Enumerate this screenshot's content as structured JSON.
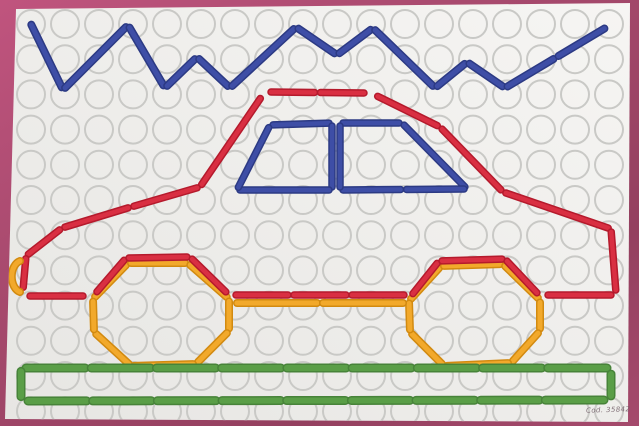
{
  "board": {
    "width": 639,
    "height": 426,
    "caption": "Cod. 35842",
    "caption_pos": {
      "x": 586,
      "y": 406
    },
    "frame_color_top": "#c0547e",
    "frame_color_bottom": "#94405f",
    "surface_color_light": "#f6f5f3",
    "surface_color_dark": "#e7e6e3",
    "corners": "16,9 630,3 628,422 5,419",
    "hole_grid": {
      "cols": 18,
      "rows": 12,
      "origin_x": 31,
      "origin_y": 24,
      "spacing_x": 34,
      "spacing_y": 35.2,
      "radius": 14,
      "stroke": "#c9c9c6",
      "stroke_width": 2
    }
  },
  "palette": {
    "blue": {
      "main": "#3e4ea6",
      "dark": "#2c3a84"
    },
    "red": {
      "main": "#d92f42",
      "dark": "#b51a2c"
    },
    "orange": {
      "main": "#f2a92b",
      "dark": "#d28a10"
    },
    "green": {
      "main": "#5a9e47",
      "dark": "#478339"
    }
  },
  "figure": {
    "description": "peg-stick picture of a car with mountains and road",
    "shapes": [
      {
        "name": "mountain-range",
        "color": "blue",
        "width": 8,
        "type": "polyline",
        "maxlen": 70,
        "points": [
          [
            30,
            22
          ],
          [
            63,
            90
          ],
          [
            128,
            25
          ],
          [
            165,
            88
          ],
          [
            197,
            57
          ],
          [
            230,
            88
          ],
          [
            296,
            27
          ],
          [
            337,
            55
          ],
          [
            373,
            28
          ],
          [
            435,
            88
          ],
          [
            467,
            62
          ],
          [
            505,
            88
          ],
          [
            607,
            27
          ]
        ]
      },
      {
        "name": "car-roof",
        "color": "red",
        "width": 7.5,
        "type": "polyline",
        "maxlen": 60,
        "points": [
          [
            268,
            92
          ],
          [
            367,
            93
          ]
        ]
      },
      {
        "name": "car-front-profile",
        "color": "red",
        "width": 7.5,
        "type": "polyline",
        "maxlen": 75,
        "points": [
          [
            262,
            96
          ],
          [
            200,
            187
          ],
          [
            131,
            207
          ],
          [
            62,
            228
          ],
          [
            26,
            256
          ],
          [
            23,
            290
          ]
        ]
      },
      {
        "name": "car-rear-profile",
        "color": "red",
        "width": 7.5,
        "type": "polyline",
        "maxlen": 95,
        "points": [
          [
            375,
            95
          ],
          [
            440,
            127
          ],
          [
            503,
            192
          ],
          [
            611,
            229
          ],
          [
            616,
            293
          ]
        ]
      },
      {
        "name": "car-floor-front",
        "color": "red",
        "width": 7.5,
        "type": "polyline",
        "maxlen": 65,
        "points": [
          [
            27,
            296
          ],
          [
            86,
            296
          ]
        ]
      },
      {
        "name": "car-floor-mid",
        "color": "red",
        "width": 7.5,
        "type": "polyline",
        "maxlen": 65,
        "points": [
          [
            233,
            295
          ],
          [
            407,
            295
          ]
        ]
      },
      {
        "name": "car-floor-rear",
        "color": "red",
        "width": 7.5,
        "type": "polyline",
        "maxlen": 65,
        "points": [
          [
            545,
            295
          ],
          [
            614,
            295
          ]
        ]
      },
      {
        "name": "left-window",
        "color": "blue",
        "width": 7.5,
        "type": "polygon",
        "maxlen": 75,
        "points": [
          [
            270,
            125
          ],
          [
            332,
            123
          ],
          [
            332,
            190
          ],
          [
            237,
            190
          ]
        ]
      },
      {
        "name": "right-window",
        "color": "blue",
        "width": 7.5,
        "type": "polygon",
        "maxlen": 75,
        "points": [
          [
            340,
            123
          ],
          [
            402,
            123
          ],
          [
            467,
            189
          ],
          [
            340,
            190
          ]
        ]
      },
      {
        "name": "front-wheel",
        "color": "orange",
        "width": 8,
        "type": "polygon",
        "maxlen": 85,
        "points": [
          [
            93,
            299
          ],
          [
            128,
            263
          ],
          [
            188,
            263
          ],
          [
            229,
            299
          ],
          [
            229,
            331
          ],
          [
            196,
            364
          ],
          [
            131,
            366
          ],
          [
            94,
            332
          ]
        ]
      },
      {
        "name": "rear-wheel",
        "color": "orange",
        "width": 8,
        "type": "polygon",
        "maxlen": 85,
        "points": [
          [
            409,
            301
          ],
          [
            441,
            266
          ],
          [
            503,
            264
          ],
          [
            540,
            300
          ],
          [
            540,
            331
          ],
          [
            511,
            363
          ],
          [
            444,
            366
          ],
          [
            410,
            332
          ]
        ]
      },
      {
        "name": "front-wheel-arch",
        "color": "red",
        "width": 7.5,
        "type": "polyline",
        "maxlen": 75,
        "points": [
          [
            95,
            294
          ],
          [
            126,
            258
          ],
          [
            190,
            257
          ],
          [
            228,
            294
          ]
        ]
      },
      {
        "name": "rear-wheel-arch",
        "color": "red",
        "width": 7.5,
        "type": "polyline",
        "maxlen": 75,
        "points": [
          [
            411,
            296
          ],
          [
            439,
            261
          ],
          [
            505,
            259
          ],
          [
            539,
            295
          ]
        ]
      },
      {
        "name": "axle-bar",
        "color": "orange",
        "width": 8,
        "type": "polyline",
        "maxlen": 95,
        "points": [
          [
            234,
            303
          ],
          [
            406,
            303
          ]
        ]
      },
      {
        "name": "front-bumper",
        "color": "orange",
        "width": 8,
        "type": "arc",
        "path": "M 20 261 A 11 16 0 0 0 20 292"
      },
      {
        "name": "ground-top",
        "color": "green",
        "width": 9,
        "type": "polyline",
        "maxlen": 62,
        "points": [
          [
            23,
            368
          ],
          [
            610,
            368
          ]
        ]
      },
      {
        "name": "ground-bottom",
        "color": "green",
        "width": 9,
        "type": "polyline",
        "maxlen": 62,
        "points": [
          [
            25,
            401
          ],
          [
            607,
            400
          ]
        ]
      },
      {
        "name": "ground-left-end",
        "color": "green",
        "width": 9,
        "type": "polyline",
        "maxlen": 62,
        "points": [
          [
            21,
            369
          ],
          [
            21,
            399
          ]
        ]
      },
      {
        "name": "ground-right-end",
        "color": "green",
        "width": 9,
        "type": "polyline",
        "maxlen": 62,
        "points": [
          [
            611,
            372
          ],
          [
            611,
            398
          ]
        ]
      }
    ]
  }
}
